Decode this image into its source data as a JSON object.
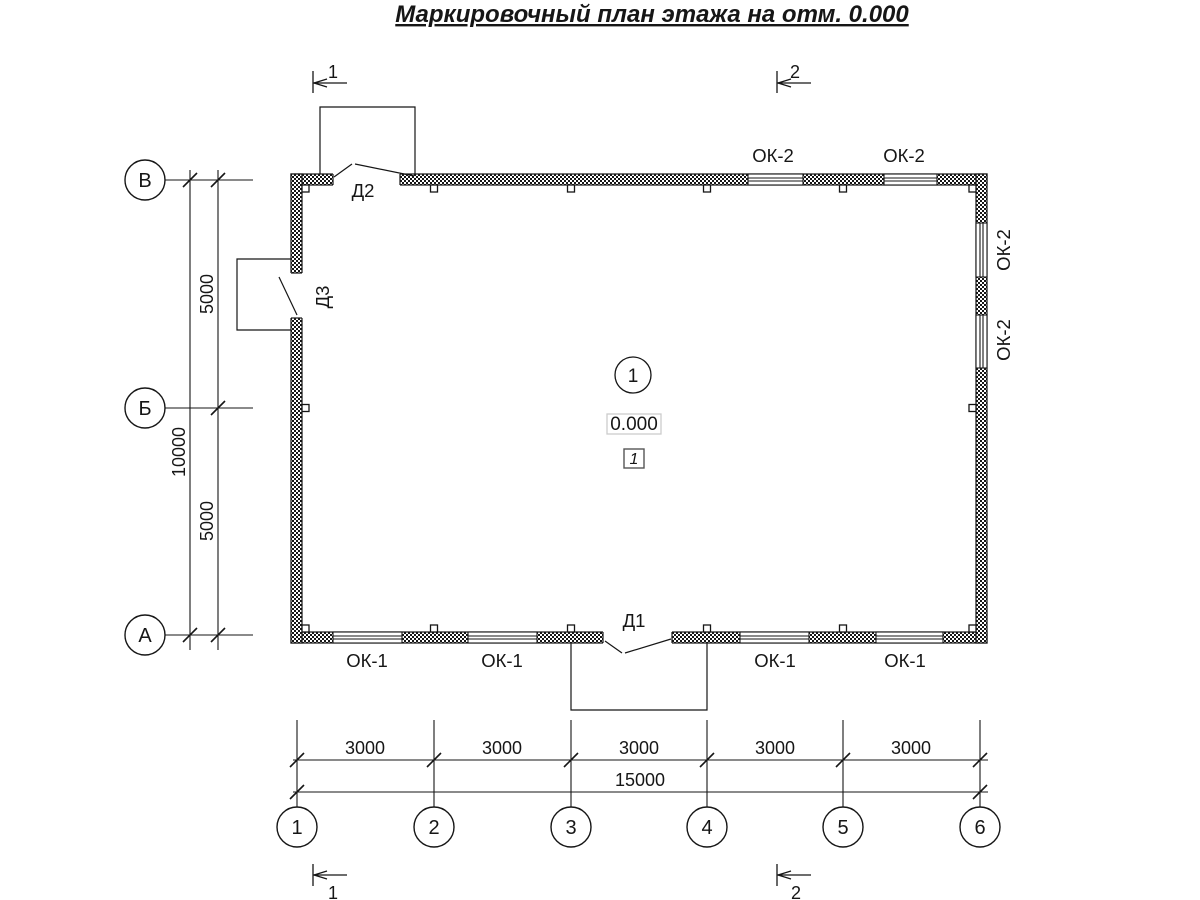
{
  "title": "Маркировочный план этажа на отм. 0.000",
  "axes": {
    "rows": [
      "В",
      "Б",
      "А"
    ],
    "cols": [
      "1",
      "2",
      "3",
      "4",
      "5",
      "6"
    ]
  },
  "dims": {
    "left": {
      "segments": [
        "5000",
        "5000"
      ],
      "total": "10000"
    },
    "bottom": {
      "segments": [
        "3000",
        "3000",
        "3000",
        "3000",
        "3000"
      ],
      "total": "15000"
    }
  },
  "windows": {
    "bottom": [
      "ОК-1",
      "ОК-1",
      "ОК-1",
      "ОК-1"
    ],
    "top": [
      "ОК-2",
      "ОК-2"
    ],
    "right": [
      "ОК-2",
      "ОК-2"
    ]
  },
  "doors": {
    "d1": "Д1",
    "d2": "Д2",
    "d3": "Д3"
  },
  "room": {
    "number": "1",
    "elevation": "0.000",
    "zone": "1"
  },
  "sections": {
    "top": [
      "1",
      "2"
    ],
    "bottom": [
      "1",
      "2"
    ]
  },
  "colors": {
    "ink": "#161616",
    "elevation_box_border": "#cccccc"
  }
}
